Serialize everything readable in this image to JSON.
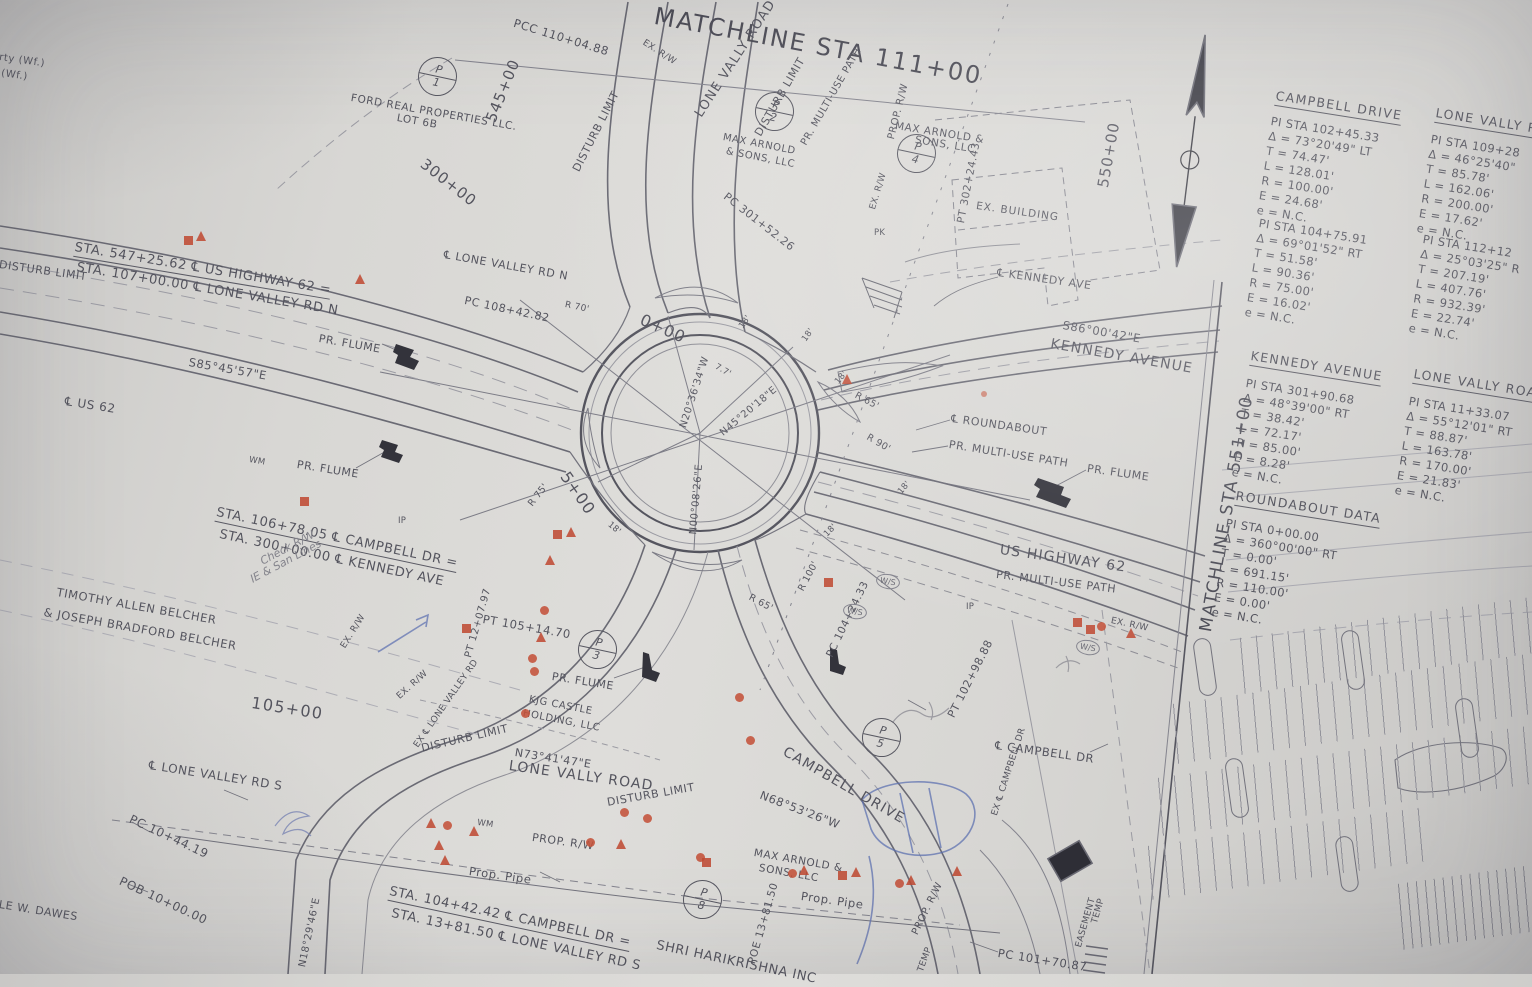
{
  "colors": {
    "paper": "#d8d7d4",
    "ink": "#54545e",
    "road": "#62626c",
    "red_marker": "#bf4b34",
    "blue_pen": "#5b6fb0"
  },
  "labels": {
    "wf1": "rty (Wf.)",
    "wf2": "(Wf.)",
    "ford1": "FORD REAL PROPERTIES LLC.",
    "ford2": "LOT 6B",
    "sta_545": "545+00",
    "sta_300": "300+00",
    "sta_550": "550+00",
    "sta_105": "105+00",
    "sta_0": "0+00",
    "sta_5": "5+00",
    "pcc": "PCC  110+04.88",
    "matchline_top": "MATCHLINE STA 111+00",
    "matchline_right": "MATCHLINE STA 551+00",
    "ex_rw": "EX. R/W",
    "prop_rw": "PROP. R/W",
    "disturb": "DISTURB LIMIT",
    "lone_vally_road": "LONE VALLY ROAD",
    "max_arnold_a1": "MAX ARNOLD",
    "max_arnold_a2": "& SONS, LLC",
    "max_arnold_b1": "MAX ARNOLD &",
    "max_arnold_b2": "SONS, LLC",
    "pr_multiuse": "PR. MULTI-USE PATH",
    "pr_flume": "PR. FLUME",
    "pc_301": "PC  301+52.26",
    "pt_302": "PT  302+24.43",
    "ex_building": "EX. BUILDING",
    "pk": "PK",
    "ip": "IP",
    "wm": "WM",
    "ws": "W/S",
    "cl_kennedy": "℄ KENNEDY AVE",
    "s86": "S86°00'42\"E",
    "kennedy_avenue": "KENNEDY AVENUE",
    "cl_roundabout": "℄ ROUNDABOUT",
    "us_highway_62": "US HIGHWAY 62",
    "sta_547_1": "STA. 547+25.62 ℄ US HIGHWAY 62 =",
    "sta_547_2": "STA. 107+00.00 ℄ LONE VALLEY RD N",
    "cl_lone_valley_rd_n": "℄ LONE VALLEY RD N",
    "s85": "S85°45'57\"E",
    "cl_us62": "℄ US 62",
    "pc_108": "PC 108+42.82",
    "r70": "R 70'",
    "r65": "R 65'",
    "r90": "R 90'",
    "r100": "R 100'",
    "r75": "R 75'",
    "d18": "18'",
    "d77": "7.7'",
    "n20": "N20°36'34\"W",
    "n45": "N45°20'18\"E",
    "n00": "N00°08'26\"E",
    "pc_104": "PC 104+24.33",
    "pt_102": "PT  102+98.88",
    "sta_106_1": "STA. 106+78.05 ℄ CAMPBELL DR =",
    "sta_106_2": "STA. 300+00.00 ℄ KENNEDY AVE",
    "check1": "Check R/W",
    "check2": "IE & San Lines",
    "belcher1": "TIMOTHY ALLEN BELCHER",
    "belcher2": "& JOSEPH BRADFORD BELCHER",
    "cl_lone_valley_rd_s": "℄ LONE VALLEY RD S",
    "pc_10": "PC  10+44.19",
    "pob_10": "POB 10+00.00",
    "dawes": "LE W. DAWES",
    "n18": "N18°29'46\"E",
    "kjg1": "KJG CASTLE",
    "kjg2": "HOLDING, LLC",
    "n73": "N73°41'47\"E",
    "pt_105": "PT  105+14.70",
    "pt_12": "PT 12+07.97",
    "ex_cl_lone": "EX ℄ LONE VALLEY RD",
    "ex_cl_campbell": "EX ℄ CAMPBELL DR",
    "cl_campbell_dr": "℄ CAMPBELL DR",
    "campbell_drive_road": "CAMPBELL DRIVE",
    "n68": "N68°53'26\"W",
    "prop_pipe": "Prop. Pipe",
    "sta_104_1": "STA. 104+42.42 ℄ CAMPBELL DR =",
    "sta_104_2": "STA. 13+81.50 ℄ LONE VALLEY RD S",
    "shri": "SHRI HARIKRISHNA INC",
    "poe_13": "POE 13+81.50",
    "temp": "TEMP",
    "easement": "EASEMENT",
    "pc_101": "PC  101+70.87"
  },
  "p_markers": {
    "letter": "P",
    "n1": "1",
    "n2": "2",
    "n3": "3",
    "n4": "4",
    "n5": "5",
    "n8": "8"
  },
  "tables": {
    "campbell": {
      "title": "CAMPBELL DRIVE",
      "b1": [
        "PI STA 102+45.33",
        "Δ = 73°20'49\" LT",
        "T = 74.47'",
        "L = 128.01'",
        "R = 100.00'",
        "E = 24.68'",
        "e = N.C."
      ],
      "b2": [
        "PI STA 104+75.91",
        "Δ = 69°01'52\" RT",
        "T = 51.58'",
        "L = 90.36'",
        "R = 75.00'",
        "E = 16.02'",
        "e = N.C."
      ]
    },
    "lone_vally_rd_upper": {
      "title": "LONE VALLY R",
      "b1": [
        "PI STA 109+28",
        "Δ = 46°25'40\"",
        "T = 85.78'",
        "L = 162.06'",
        "R = 200.00'",
        "E = 17.62'",
        "e = N.C."
      ],
      "b2": [
        "PI STA 112+12",
        "Δ = 25°03'25\" R",
        "T = 207.19'",
        "L = 407.76'",
        "R = 932.39'",
        "E = 22.74'",
        "e = N.C."
      ]
    },
    "kennedy": {
      "title": "KENNEDY AVENUE",
      "b1": [
        "PI STA 301+90.68",
        "Δ = 48°39'00\" RT",
        "T = 38.42'",
        "L = 72.17'",
        "R = 85.00'",
        "E = 8.28'",
        "e = N.C."
      ]
    },
    "lone_vally_road_lower": {
      "title": "LONE VALLY ROA",
      "b1": [
        "PI STA 11+33.07",
        "Δ = 55°12'01\" RT",
        "T = 88.87'",
        "L = 163.78'",
        "R = 170.00'",
        "E = 21.83'",
        "e = N.C."
      ]
    },
    "roundabout": {
      "title": "ROUNDABOUT DATA",
      "b1": [
        "PI STA 0+00.00",
        "Δ = 360°00'00\" RT",
        "T = 0.00'",
        "L = 691.15'",
        "R = 110.00'",
        "E = 0.00'",
        "e = N.C."
      ]
    }
  }
}
